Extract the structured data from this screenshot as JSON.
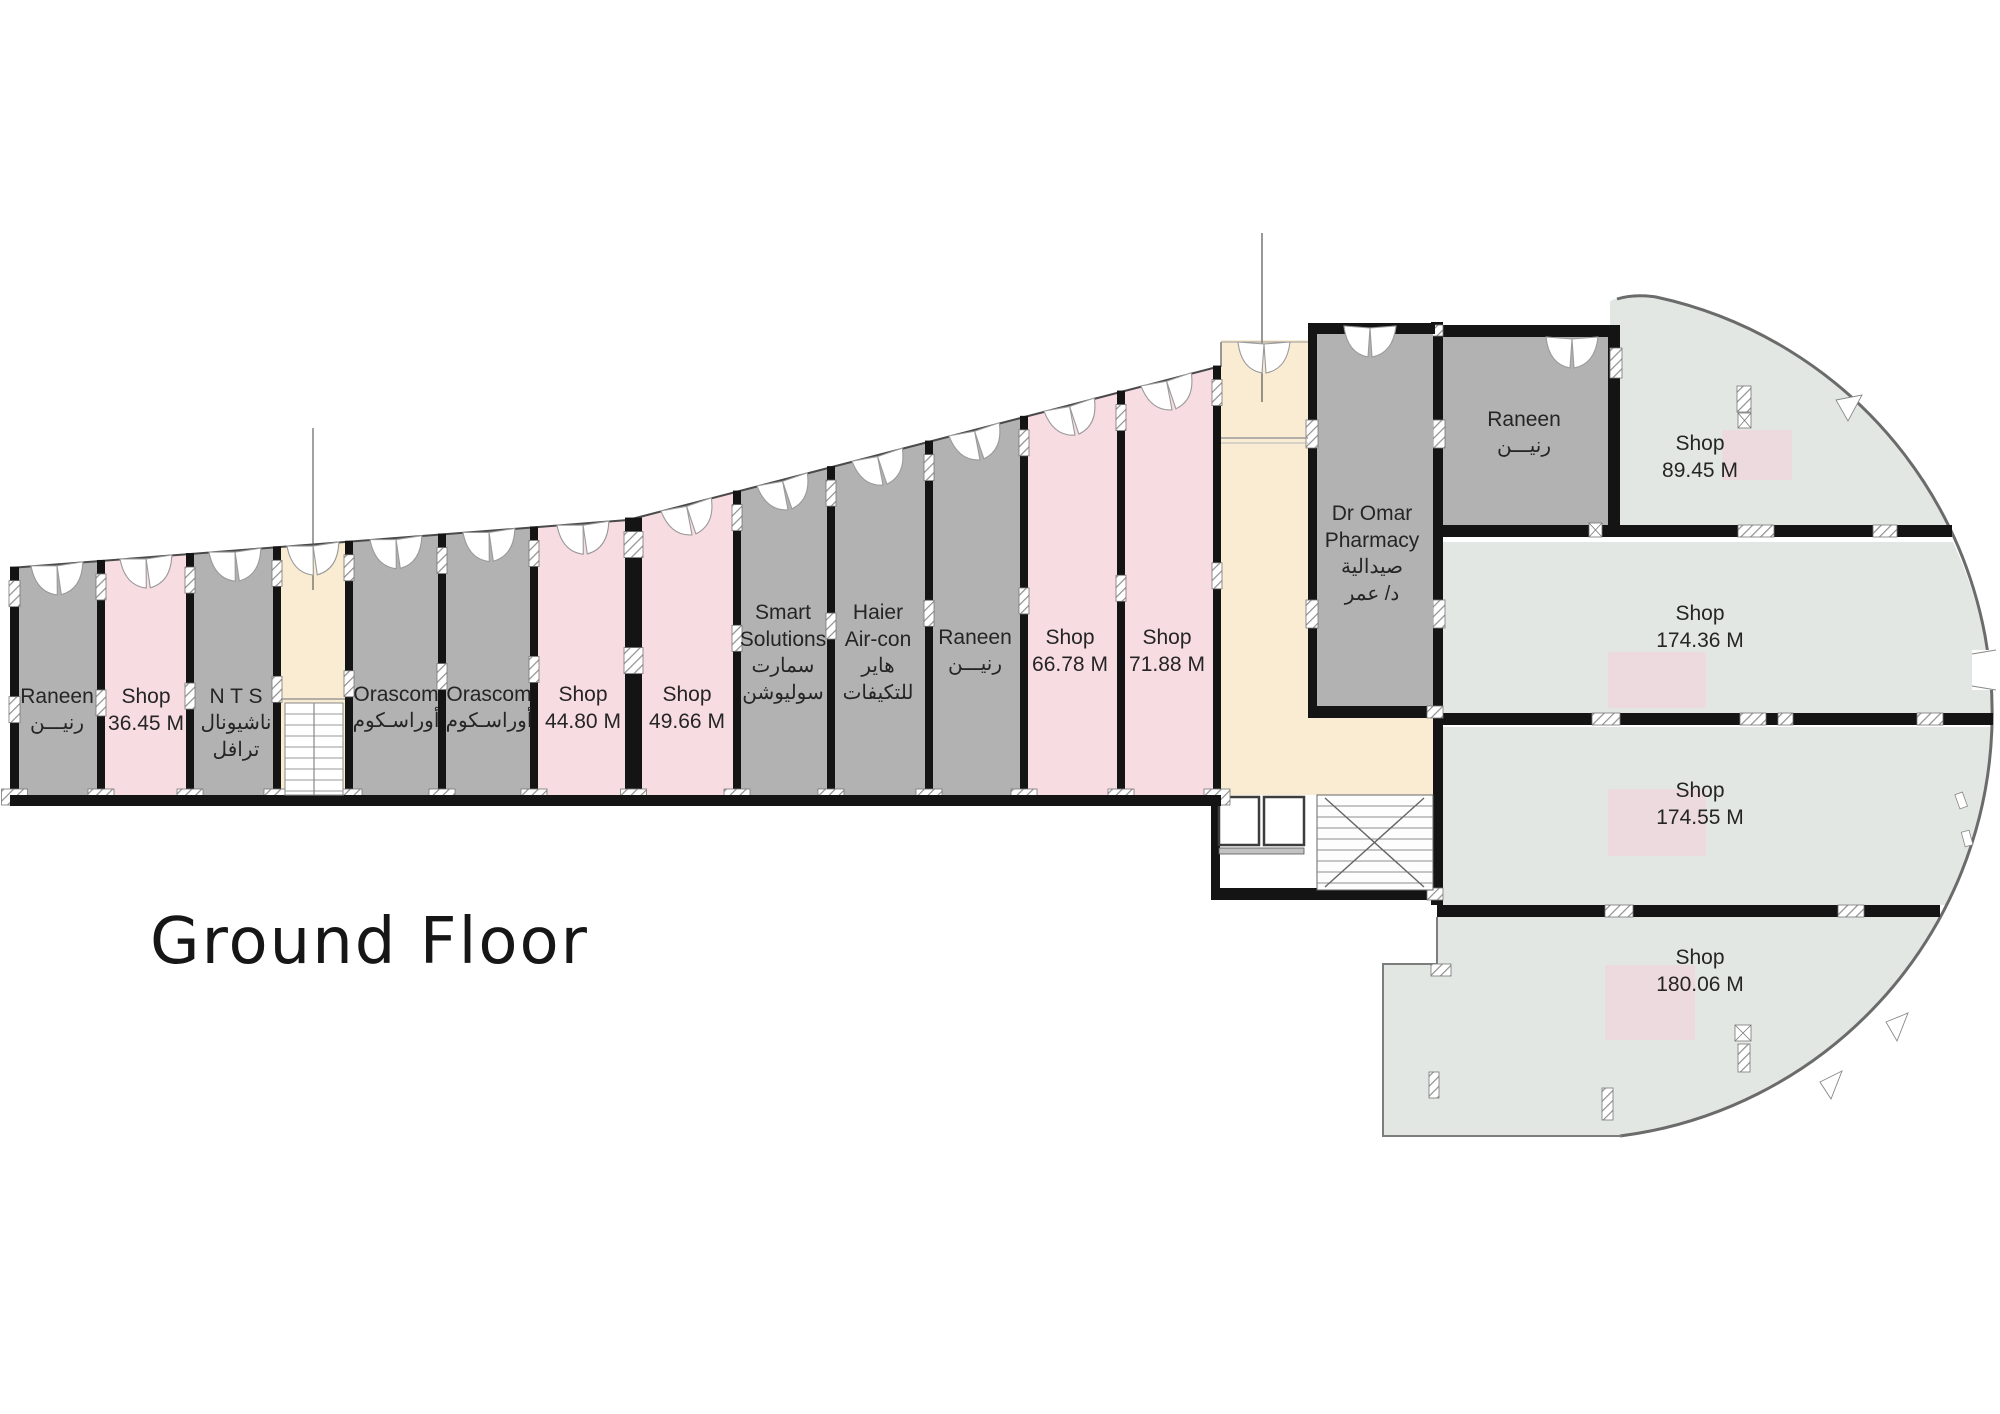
{
  "title": "Ground Floor",
  "colors": {
    "shop_gray": "#b3b2b2",
    "shop_pink": "#f7dce2",
    "shop_mint": "#e2e7e4",
    "corridor_beige": "#f9ecd2",
    "highlight_pink": "#f6cdd7",
    "wall": "#141414",
    "outline": "#6b6b6b",
    "text": "#252525"
  },
  "units": [
    {
      "id": "raneen-1",
      "lines": [
        "Raneen",
        "رنيـــن"
      ]
    },
    {
      "id": "shop-36",
      "lines": [
        "Shop",
        "36.45 M"
      ]
    },
    {
      "id": "nts",
      "lines": [
        "N T S",
        "ناشيونال",
        "ترافل"
      ]
    },
    {
      "id": "orascom-1",
      "lines": [
        "Orascom",
        "أوراسـكوم"
      ]
    },
    {
      "id": "orascom-2",
      "lines": [
        "Orascom",
        "أوراسـكوم"
      ]
    },
    {
      "id": "shop-44",
      "lines": [
        "Shop",
        "44.80 M"
      ]
    },
    {
      "id": "shop-49",
      "lines": [
        "Shop",
        "49.66 M"
      ]
    },
    {
      "id": "smart-solutions",
      "lines": [
        "Smart",
        "Solutions",
        "سمارت",
        "سوليوشن"
      ]
    },
    {
      "id": "haier",
      "lines": [
        "Haier",
        "Air-con",
        "هاير",
        "للتكيفات"
      ]
    },
    {
      "id": "raneen-2",
      "lines": [
        "Raneen",
        "رنيـــن"
      ]
    },
    {
      "id": "shop-66",
      "lines": [
        "Shop",
        "66.78 M"
      ]
    },
    {
      "id": "shop-71",
      "lines": [
        "Shop",
        "71.88 M"
      ]
    },
    {
      "id": "pharmacy",
      "lines": [
        "Dr Omar",
        "Pharmacy",
        "صيدالية",
        "د/ عمر"
      ]
    },
    {
      "id": "raneen-3",
      "lines": [
        "Raneen",
        "رنيـــن"
      ]
    },
    {
      "id": "shop-89",
      "lines": [
        "Shop",
        "89.45 M"
      ]
    },
    {
      "id": "shop-174a",
      "lines": [
        "Shop",
        "174.36 M"
      ]
    },
    {
      "id": "shop-174b",
      "lines": [
        "Shop",
        "174.55 M"
      ]
    },
    {
      "id": "shop-180",
      "lines": [
        "Shop",
        "180.06 M"
      ]
    }
  ]
}
